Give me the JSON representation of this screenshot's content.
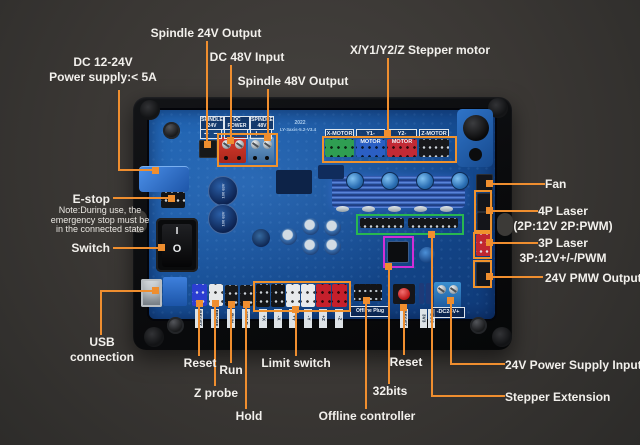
{
  "colors": {
    "accent_orange": "#EF8E2F",
    "box_green": "#28B750",
    "box_magenta": "#D02ED6",
    "label_white": "#F2F0EC",
    "pcb_blue": "#1A5CA6"
  },
  "callouts": {
    "spindle24_output": "Spindle 24V Output",
    "dc48_input": "DC 48V Input",
    "spindle48_output": "Spindle 48V Output",
    "stepper_motor": "X/Y1/Y2/Z Stepper motor",
    "dc_power_line1": "DC 12-24V",
    "dc_power_line2": "Power supply:< 5A",
    "estop": "E-stop",
    "estop_note_line1": "Note:During use, the",
    "estop_note_line2": "emergency stop must be",
    "estop_note_line3": "in the connected state",
    "switch": "Switch",
    "usb_line1": "USB",
    "usb_line2": "connection",
    "reset_left": "Reset",
    "z_probe": "Z probe",
    "run": "Run",
    "hold": "Hold",
    "limit_switch": "Limit switch",
    "offline_controller": "Offline controller",
    "bits32": "32bits",
    "reset_right": "Reset",
    "psu_input": "24V Power Supply Input",
    "stepper_extension": "Stepper Extension",
    "fan": "Fan",
    "laser4p_line1": "4P Laser",
    "laser4p_line2": "(2P:12V 2P:PWM)",
    "laser3p_line1": "3P Laser",
    "laser3p_line2": "3P:12V+/-/PWM",
    "pmw_output": "24V PMW Output"
  },
  "board": {
    "silk_spindle24_l1": "SPINDLE",
    "silk_spindle24_l2": "24V",
    "silk_dcpower_l1": "DC POWER",
    "silk_dcpower_l2": "48V",
    "silk_spindle48_l1": "SPINDLE",
    "silk_spindle48_l2": "48V",
    "plus": "+",
    "minus": "−",
    "year": "2022",
    "model": "LY-3axis-5.2-V3.4",
    "motors": [
      "X-MOTOR",
      "Y1-MOTOR",
      "Y2-MOTOR",
      "Z-MOTOR"
    ],
    "io_labels": [
      "RESET",
      "PROBE",
      "RUN",
      "HOLD"
    ],
    "limit_labels": [
      "+X",
      "-X",
      "+Y",
      "-Y",
      "+Z",
      "-Z"
    ],
    "offline_plug": "Offline Plug",
    "reset_button": "RESET",
    "bus_l1": "3V3",
    "bus_l2": "BUS",
    "dc24_terminal": "-DC24V+",
    "cap_marking": "100 63V",
    "switch_on": "I",
    "switch_off": "O"
  }
}
